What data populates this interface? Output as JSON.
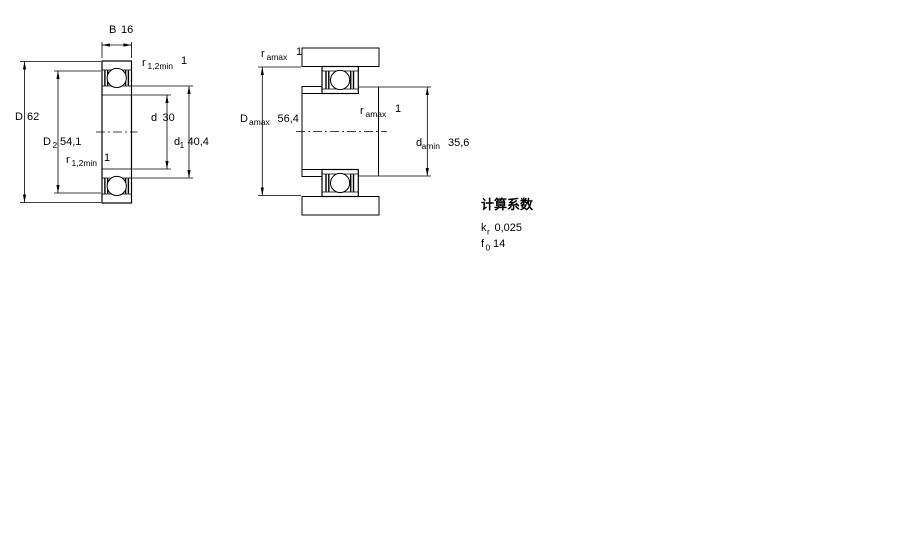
{
  "cross_section_view": {
    "width_B": {
      "symbol": "B",
      "value": "16"
    },
    "outer_diameter_D": {
      "symbol": "D",
      "value": "62"
    },
    "recess_diameter_D2": {
      "symbol": "D",
      "sub": "2",
      "value": "54,1"
    },
    "chamfer_top_r12": {
      "symbol": "r",
      "sub": "1,2min",
      "value": "1"
    },
    "chamfer_bottom_r12": {
      "symbol": "r",
      "sub": "1,2min",
      "value": "1"
    },
    "bore_diameter_d": {
      "symbol": "d",
      "value": "30"
    },
    "shoulder_diameter_d1": {
      "symbol": "d",
      "sub": "1",
      "value": "40,4"
    }
  },
  "mounting_view": {
    "housing_fillet_ramax": {
      "symbol": "r",
      "sub": "amax",
      "value": "1"
    },
    "housing_abutment_Damax": {
      "symbol": "D",
      "sub": "amax",
      "value": "56,4"
    },
    "shaft_fillet_ramax": {
      "symbol": "r",
      "sub": "amax",
      "value": "1"
    },
    "shaft_abutment_damin": {
      "symbol": "d",
      "sub": "amin",
      "value": "35,6"
    }
  },
  "calculation_factors": {
    "title": "计算系数",
    "kr": {
      "symbol": "k",
      "sub": "r",
      "value": "0,025"
    },
    "f0": {
      "symbol": "f",
      "sub": "0",
      "value": "14"
    }
  },
  "colors": {
    "hatch_base": "#b4cfe7",
    "hatch_dot": "#7fa6ca",
    "line": "#000000"
  }
}
